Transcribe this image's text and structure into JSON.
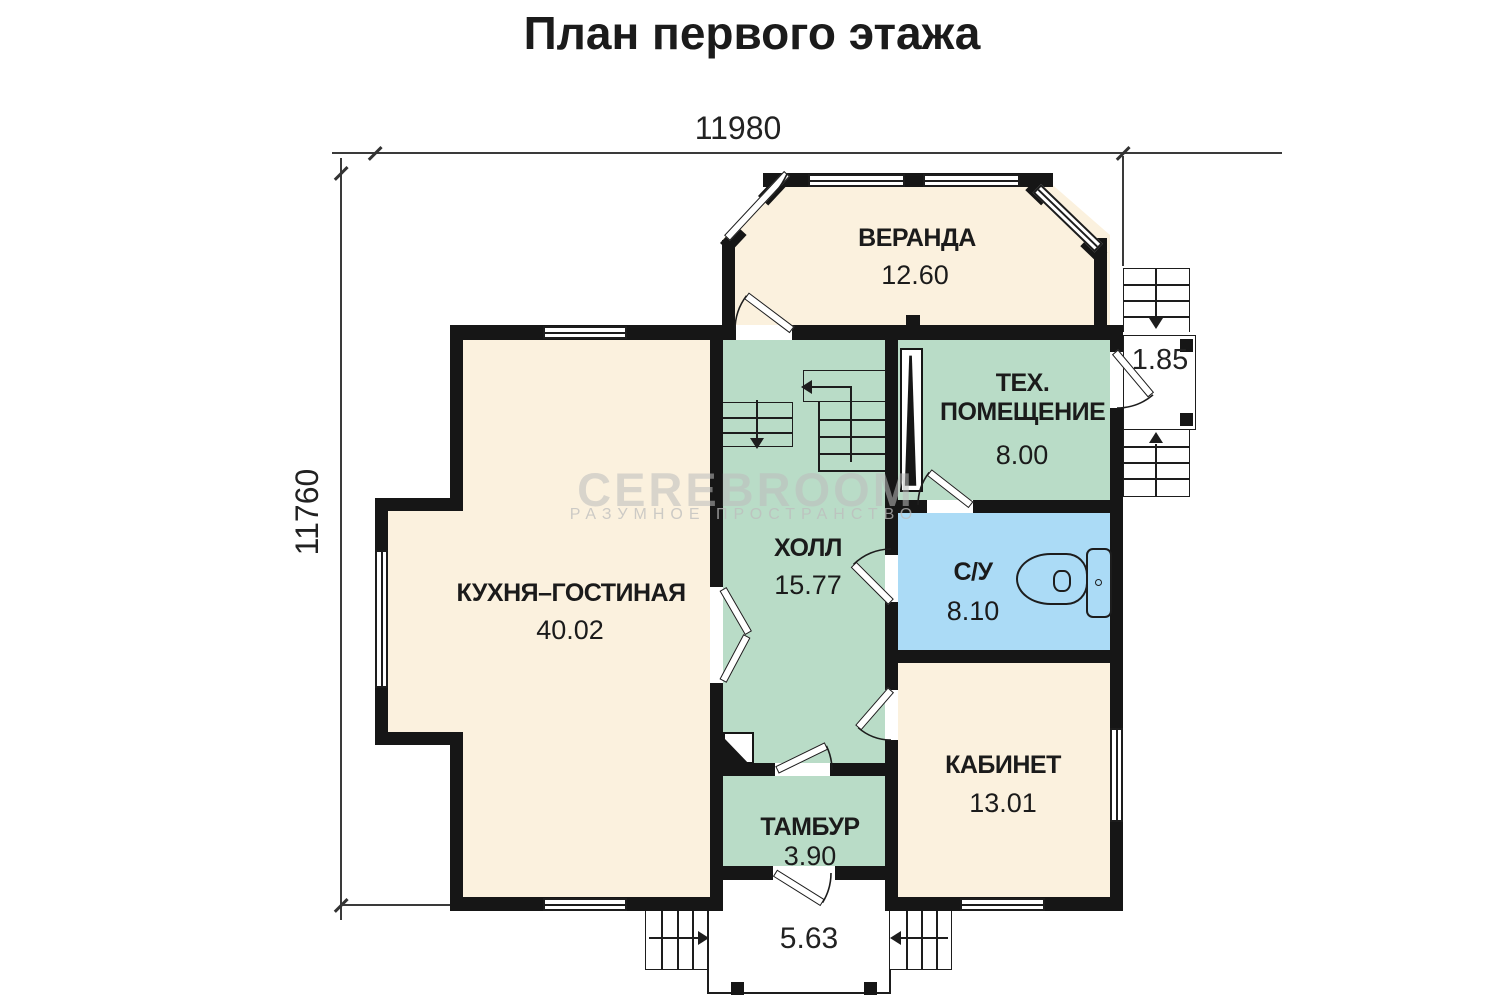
{
  "title": "План первого этажа",
  "watermark": {
    "brand": "CEREBROOM",
    "tagline": "РАЗУМНОЕ  ПРОСТРАНСТВО"
  },
  "dimensions": {
    "width_total": "11980",
    "height_total": "11760",
    "right_porch_width": "1.85",
    "entrance_porch_width": "5.63"
  },
  "rooms": {
    "veranda": {
      "name": "ВЕРАНДА",
      "area": "12.60"
    },
    "tech": {
      "name": "ТЕХ. ПОМЕЩЕНИЕ",
      "area": "8.00"
    },
    "hall": {
      "name": "ХОЛЛ",
      "area": "15.77"
    },
    "wc": {
      "name": "С/У",
      "area": "8.10"
    },
    "kitchen": {
      "name": "КУХНЯ–ГОСТИНАЯ",
      "area": "40.02"
    },
    "cabinet": {
      "name": "КАБИНЕТ",
      "area": "13.01"
    },
    "tambour": {
      "name": "ТАМБУР",
      "area": "3.90"
    }
  },
  "colors": {
    "room_cream": "#FBF1DE",
    "room_green": "#B9DCC7",
    "room_blue": "#ABDBF6",
    "wall": "#161616",
    "watermark": "#BDBDBD"
  }
}
